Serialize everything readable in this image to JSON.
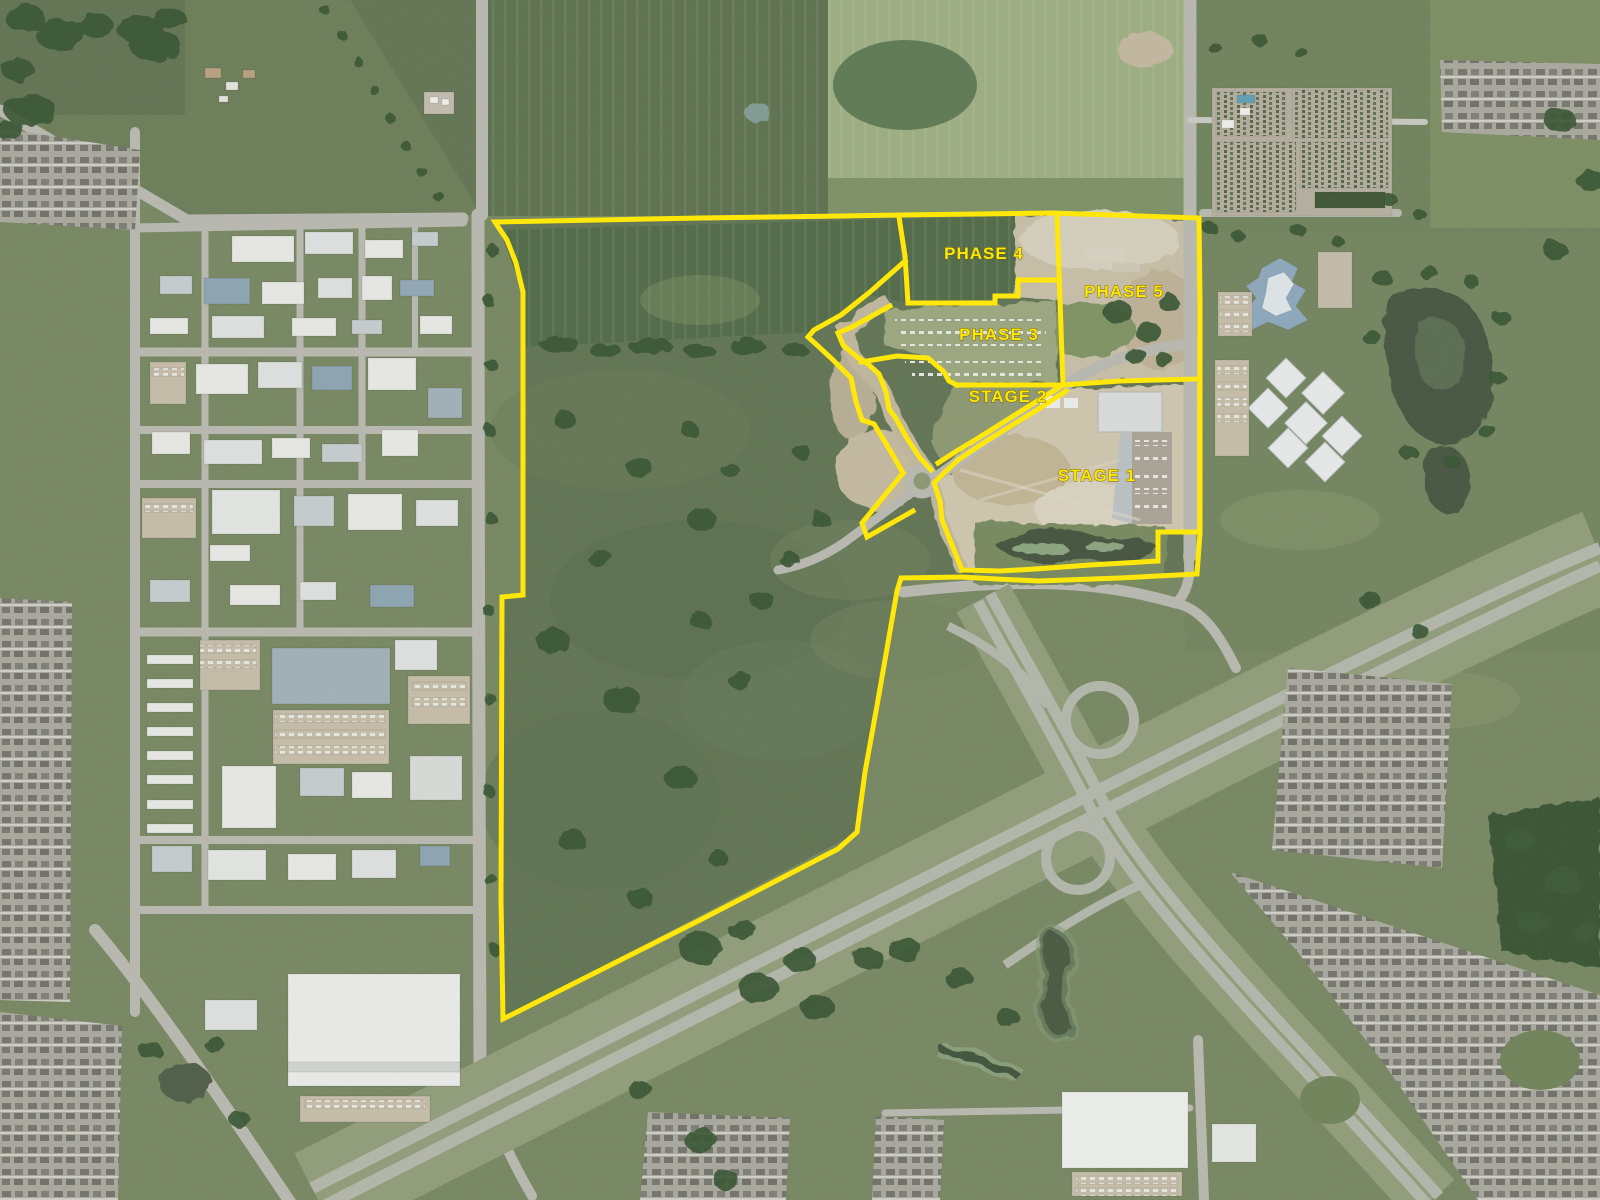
{
  "map": {
    "type": "satellite-aerial-development-plan",
    "annotation_color": "#ffe70a",
    "annotation_outline": "#6a5c00",
    "annotation_line_width": 5,
    "label_font_size": 17,
    "labels": [
      {
        "id": "phase-4",
        "text": "PHASE 4",
        "x": 984,
        "y": 259
      },
      {
        "id": "phase-5",
        "text": "PHASE 5",
        "x": 1124,
        "y": 297
      },
      {
        "id": "phase-3",
        "text": "PHASE 3",
        "x": 999,
        "y": 340
      },
      {
        "id": "stage-2",
        "text": "STAGE 2",
        "x": 1008,
        "y": 402
      },
      {
        "id": "stage-1",
        "text": "STAGE 1",
        "x": 1097,
        "y": 481
      }
    ],
    "boundaries": [
      {
        "id": "outer-parcel",
        "closed": true,
        "points": [
          [
            495,
            222
          ],
          [
            700,
            218
          ],
          [
            843,
            216
          ],
          [
            900,
            215
          ],
          [
            1053,
            213
          ],
          [
            1199,
            218
          ],
          [
            1200,
            300
          ],
          [
            1200,
            533
          ],
          [
            1197,
            574
          ],
          [
            1120,
            578
          ],
          [
            1039,
            581
          ],
          [
            996,
            579
          ],
          [
            962,
            577
          ],
          [
            901,
            578
          ],
          [
            897,
            591
          ],
          [
            878,
            700
          ],
          [
            865,
            772
          ],
          [
            857,
            832
          ],
          [
            838,
            849
          ],
          [
            700,
            920
          ],
          [
            503,
            1019
          ],
          [
            501,
            900
          ],
          [
            502,
            597
          ],
          [
            523,
            595
          ],
          [
            523,
            292
          ],
          [
            516,
            263
          ],
          [
            507,
            240
          ]
        ]
      },
      {
        "id": "phase-4-west",
        "closed": false,
        "points": [
          [
            899,
            217
          ],
          [
            905,
            256
          ],
          [
            908,
            303
          ]
        ]
      },
      {
        "id": "phase-4-south",
        "closed": false,
        "points": [
          [
            908,
            303
          ],
          [
            960,
            303
          ],
          [
            995,
            303
          ],
          [
            995,
            296
          ],
          [
            1018,
            296
          ],
          [
            1018,
            280
          ],
          [
            1056,
            280
          ]
        ]
      },
      {
        "id": "phase-divider-east",
        "closed": false,
        "points": [
          [
            1057,
            214
          ],
          [
            1060,
            300
          ],
          [
            1063,
            385
          ]
        ]
      },
      {
        "id": "stage-1-north",
        "closed": false,
        "points": [
          [
            1063,
            385
          ],
          [
            1120,
            381
          ],
          [
            1199,
            379
          ]
        ]
      },
      {
        "id": "corridor-west",
        "closed": false,
        "points": [
          [
            905,
            261
          ],
          [
            870,
            292
          ],
          [
            841,
            315
          ],
          [
            814,
            330
          ],
          [
            808,
            337
          ],
          [
            818,
            346
          ],
          [
            832,
            359
          ],
          [
            851,
            378
          ],
          [
            856,
            402
          ],
          [
            862,
            420
          ],
          [
            874,
            424
          ],
          [
            891,
            452
          ],
          [
            903,
            473
          ]
        ]
      },
      {
        "id": "corridor-east",
        "closed": false,
        "points": [
          [
            890,
            306
          ],
          [
            852,
            327
          ],
          [
            838,
            333
          ],
          [
            843,
            345
          ],
          [
            857,
            357
          ],
          [
            868,
            364
          ],
          [
            879,
            374
          ],
          [
            886,
            392
          ],
          [
            889,
            409
          ],
          [
            895,
            417
          ],
          [
            908,
            440
          ],
          [
            920,
            458
          ],
          [
            931,
            470
          ]
        ]
      },
      {
        "id": "corridor-southwest-stub",
        "closed": false,
        "points": [
          [
            903,
            473
          ],
          [
            862,
            523
          ],
          [
            867,
            537
          ],
          [
            913,
            511
          ]
        ]
      },
      {
        "id": "phase-3-southwest",
        "closed": false,
        "points": [
          [
            861,
            362
          ],
          [
            897,
            356
          ],
          [
            928,
            358
          ],
          [
            944,
            372
          ],
          [
            949,
            381
          ],
          [
            957,
            385
          ]
        ]
      },
      {
        "id": "stage-2-north",
        "closed": false,
        "points": [
          [
            957,
            385
          ],
          [
            1060,
            385
          ]
        ]
      },
      {
        "id": "stage-2-southeast",
        "closed": false,
        "points": [
          [
            1060,
            387
          ],
          [
            1018,
            413
          ],
          [
            975,
            440
          ],
          [
            955,
            452
          ],
          [
            938,
            463
          ]
        ]
      },
      {
        "id": "stage-1-west",
        "closed": false,
        "points": [
          [
            1066,
            391
          ],
          [
            1040,
            408
          ],
          [
            985,
            442
          ],
          [
            958,
            460
          ],
          [
            945,
            472
          ],
          [
            934,
            483
          ],
          [
            940,
            501
          ],
          [
            942,
            520
          ],
          [
            952,
            545
          ],
          [
            962,
            570
          ]
        ]
      },
      {
        "id": "stage-1-south",
        "closed": false,
        "points": [
          [
            962,
            570
          ],
          [
            1000,
            571
          ],
          [
            1035,
            569
          ],
          [
            1090,
            565
          ],
          [
            1158,
            561
          ],
          [
            1158,
            532
          ],
          [
            1199,
            532
          ]
        ]
      }
    ]
  }
}
